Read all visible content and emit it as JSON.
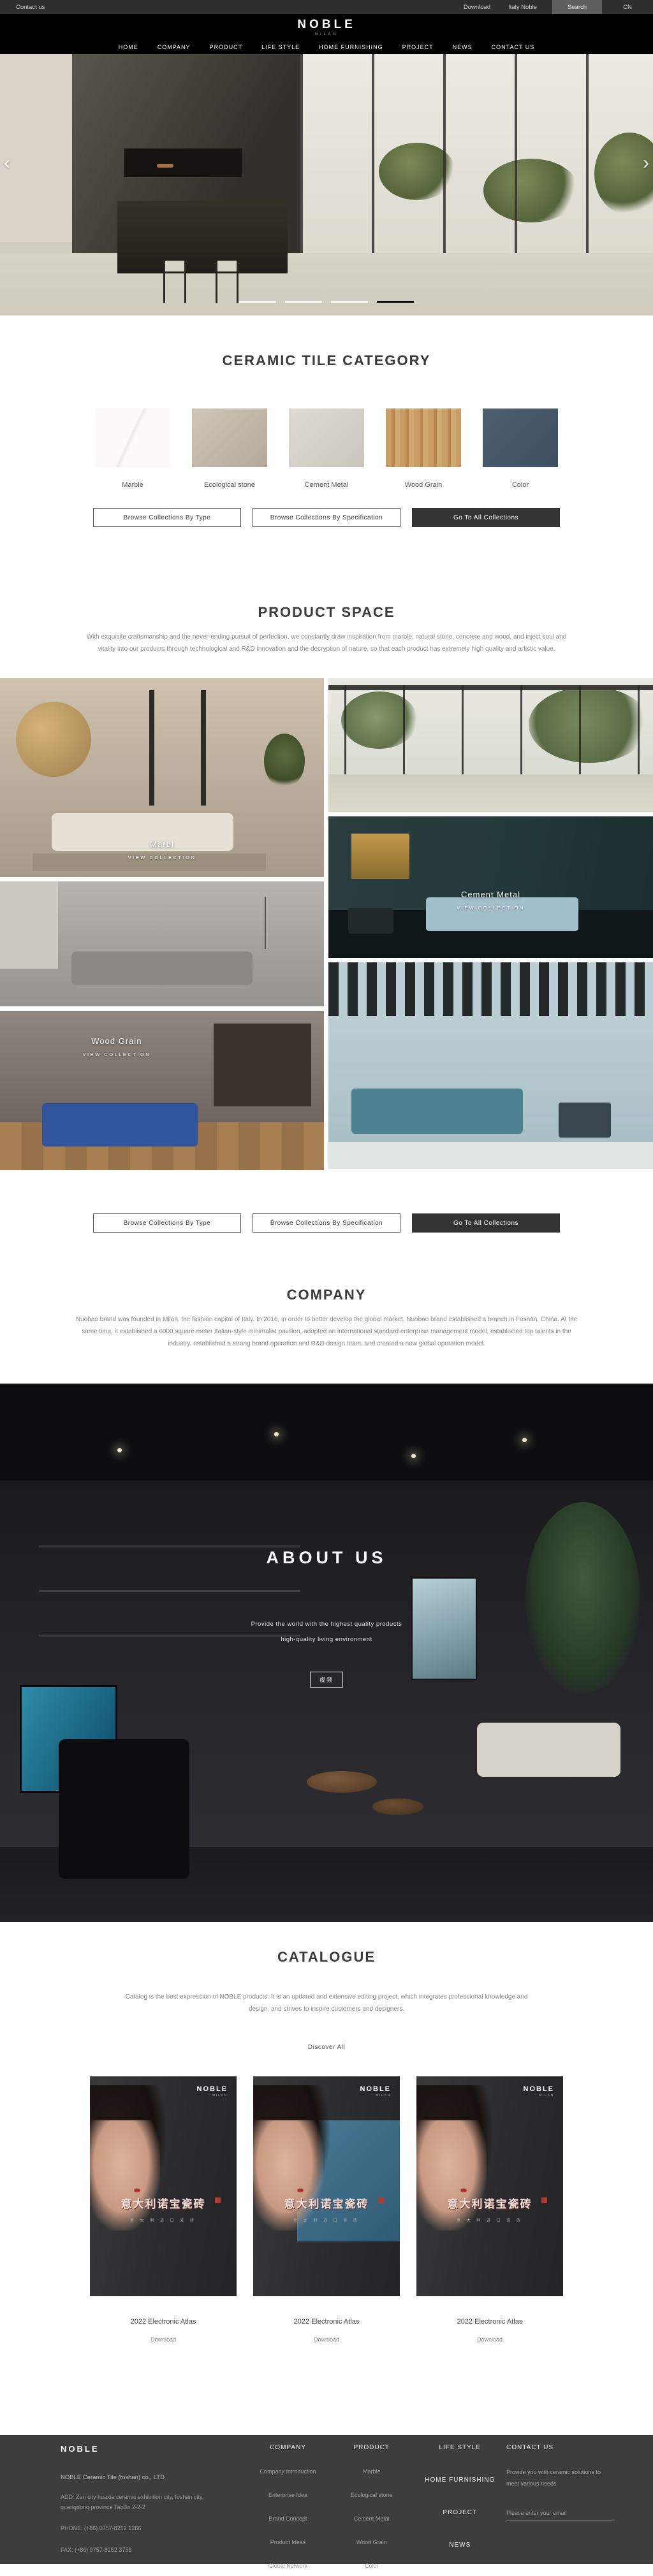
{
  "topbar": {
    "contact": "Contact us",
    "download": "Download",
    "italy": "Italy Noble",
    "search": "Search",
    "lang": "CN"
  },
  "header": {
    "logo": "NOBLE",
    "logo_sub": "MILAN",
    "nav": [
      "HOME",
      "COMPANY",
      "PRODUCT",
      "LIFE STYLE",
      "HOME FURNISHING",
      "PROJECT",
      "NEWS",
      "CONTACT US"
    ]
  },
  "hero": {
    "prev_icon": "‹",
    "next_icon": "›",
    "slides": 4,
    "active_slide": 4
  },
  "category": {
    "title": "CERAMIC TILE CATEGORY",
    "items": [
      {
        "label": "Marble"
      },
      {
        "label": "Ecological stone"
      },
      {
        "label": "Cement Metal"
      },
      {
        "label": "Wood Grain"
      },
      {
        "label": "Color"
      }
    ],
    "buttons": {
      "by_type": "Browse Collections By Type",
      "by_spec": "Browse Collections By Specification",
      "all": "Go To All Collections"
    }
  },
  "product_space": {
    "title": "PRODUCT SPACE",
    "paragraph": "With exquisite craftsmanship and the never-ending pursuit of perfection, we constantly draw inspiration from marble, natural stone, concrete and wood, and inject soul and vitality into our products through technological and R&D innovation and the decryption of nature, so that each product has extremely high quality and artistic value.",
    "cards": [
      {
        "label": "Marbl",
        "cta": "VIEW COLLECTION"
      },
      {
        "label": "Cement Metal",
        "cta": "VIEW COLLECTION"
      },
      {
        "label": "Wood Grain",
        "cta": "VIEW COLLECTION"
      }
    ]
  },
  "company": {
    "title": "COMPANY",
    "paragraph": "Nuobao brand was founded in Milan, the fashion capital of Italy. In 2016, in order to better develop the global market, Nuobao brand established a branch in Foshan, China. At the same time, it established a 6000 square meter Italian-style minimalist pavilion, adopted an international standard enterprise management model, established top talents in the industry, established a strong brand operation and R&D design team, and created a new global operation model."
  },
  "about": {
    "title": "ABOUT US",
    "line1": "Provide the world with the highest quality products",
    "line2": "high-quality living environment",
    "video_label": "视频"
  },
  "catalogue": {
    "title": "CATALOGUE",
    "paragraph": "Catalog is the best expression of NOBLE products. It is an updated and extensive editing project, which integrates professional knowledge and design, and strives to inspire customers and designers.",
    "discover": "Discover All",
    "cover_logo": "NOBLE",
    "cover_logo_sub": "MILAN",
    "cover_title": "意大利诺宝瓷砖",
    "cover_sub": "意 大 利 进 口 瓷 砖",
    "items": [
      {
        "name": "2022 Electronic Atlas",
        "download": "Download"
      },
      {
        "name": "2022 Electronic Atlas",
        "download": "Download"
      },
      {
        "name": "2022 Electronic Atlas",
        "download": "Download"
      }
    ]
  },
  "footer": {
    "logo": "NOBLE",
    "company_name": "NOBLE Ceramic Tile (foshan) co., LTD",
    "address": "ADD:  Zen city huaxia ceramic exhibition city, foshan city, guangdong province TaoBo 2-2-2",
    "phone": "PHONE:   (+86)  0757-8252 1266",
    "fax": "FAX:   (+86)  0757-8252 3758",
    "col_company": {
      "title": "COMPANY",
      "items": [
        "Company Introduction",
        "Enterprise Idea",
        "Brand Concept",
        "Product Ideas",
        "Global Network"
      ]
    },
    "col_product": {
      "title": "PRODUCT",
      "items": [
        "Marble",
        "Ecological stone",
        "Cement Metal",
        "Wood Grain",
        "Color"
      ]
    },
    "col_nav": [
      "LIFE STYLE",
      "HOME FURNISHING",
      "PROJECT",
      "NEWS"
    ],
    "contact": {
      "title": "CONTACT US",
      "text": "Provide you with ceramic solutions to meet various needs",
      "placeholder": "Please enter your email"
    }
  }
}
